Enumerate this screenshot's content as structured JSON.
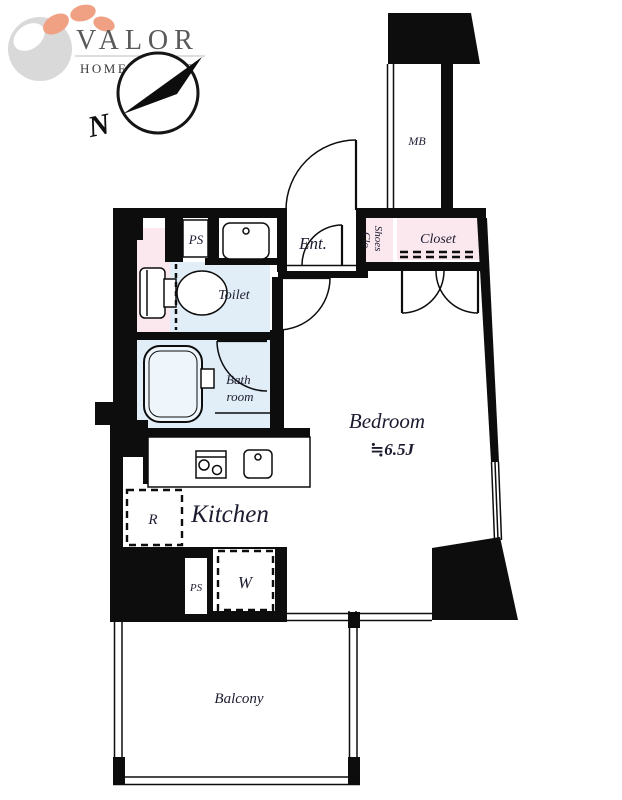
{
  "logo": {
    "title": "VALOR",
    "subtitle": "HOME ADVISE"
  },
  "compass": {
    "north_label": "N"
  },
  "colors": {
    "wall": "#0d0d0d",
    "room_pink": "#fbe7ee",
    "room_blue": "#e1eef7",
    "tub_blue": "#eef6fb",
    "logo_orange": "#f0a183",
    "logo_gray": "#d9d9d9",
    "text": "#1c1c30"
  },
  "rooms": {
    "meter_box": "MB",
    "pipe_space_top": "PS",
    "entrance": "Ent.",
    "shoes_line1": "Shoes",
    "shoes_line2": "Clo",
    "closet": "Closet",
    "toilet": "Toilet",
    "bath_line1": "Bath",
    "bath_line2": "room",
    "bedroom": "Bedroom",
    "bedroom_size": "≒6.5J",
    "kitchen": "Kitchen",
    "refrigerator": "R",
    "washer": "W",
    "pipe_space_bottom": "PS",
    "balcony": "Balcony"
  }
}
